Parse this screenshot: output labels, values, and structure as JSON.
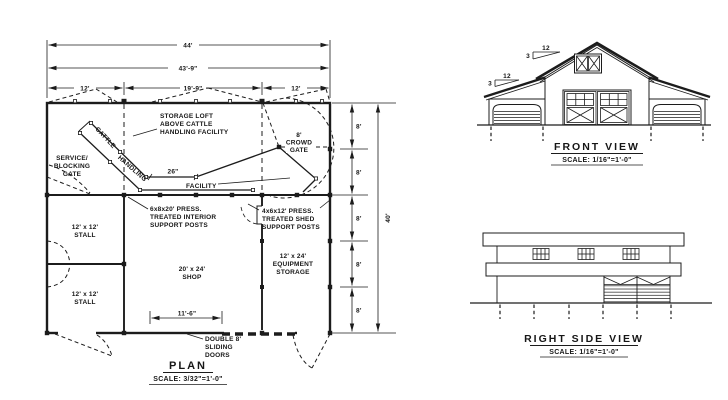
{
  "plan": {
    "title": "PLAN",
    "scale_note": "SCALE: 3/32\"=1'-0\"",
    "dims": {
      "overall_width": "44'",
      "wall_length": "43'-9\"",
      "left_shed_bay": "12'",
      "center_bay": "19'-9\"",
      "right_shed_bay": "12'",
      "overall_depth": "40'",
      "bay_depth": "8'",
      "shop_door_opening": "11'-6\"",
      "chute_width": "26\""
    },
    "labels": {
      "storage_loft": [
        "STORAGE LOFT",
        "ABOVE CATTLE",
        "HANDLING FACILITY"
      ],
      "service_gate": [
        "SERVICE/",
        "BLOCKING",
        "GATE"
      ],
      "chute_word_1": "CATTLE",
      "chute_word_2": "HANDLING",
      "chute_word_3": "FACILITY",
      "crowd_gate": [
        "8'",
        "CROWD",
        "GATE"
      ],
      "interior_posts": [
        "6x8x20' PRESS.",
        "TREATED INTERIOR",
        "SUPPORT POSTS"
      ],
      "shed_posts": [
        "4x6x12' PRESS.",
        "TREATED SHED",
        "SUPPORT POSTS"
      ],
      "stall_upper": [
        "12' x 12'",
        "STALL"
      ],
      "stall_lower": [
        "12' x 12'",
        "STALL"
      ],
      "shop": [
        "20' x 24'",
        "SHOP"
      ],
      "equipment_storage": [
        "12' x 24'",
        "EQUIPMENT",
        "STORAGE"
      ],
      "sliding_doors": [
        "DOUBLE 8'",
        "SLIDING",
        "DOORS"
      ]
    }
  },
  "front_view": {
    "title": "FRONT VIEW",
    "scale_note": "SCALE: 1/16\"=1'-0\"",
    "roof_pitch": {
      "run": "12",
      "rise": "3"
    }
  },
  "side_view": {
    "title": "RIGHT SIDE VIEW",
    "scale_note": "SCALE: 1/16\"=1'-0\""
  },
  "colors": {
    "ink": "#1c1c1c",
    "background": "#ffffff"
  }
}
